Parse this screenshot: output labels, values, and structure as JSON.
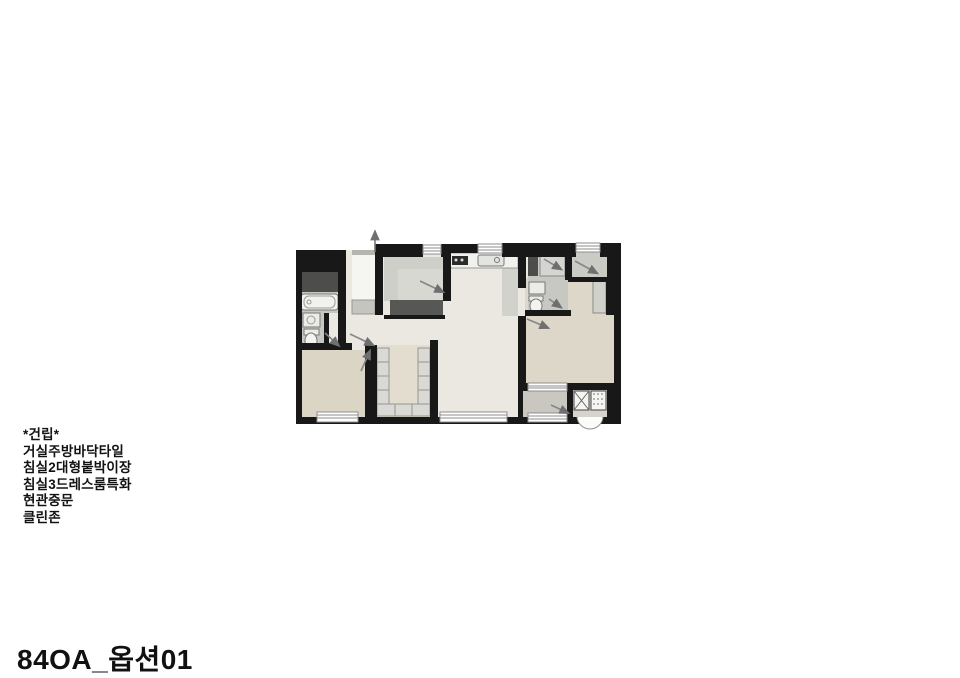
{
  "title": "84OA_옵션01",
  "notes": {
    "header": "*건립*",
    "items": [
      "거실주방바닥타일",
      "침실2대형붙박이장",
      "침실3드레스룸특화",
      "현관중문",
      "클린존"
    ]
  },
  "floor_plan": {
    "colors": {
      "wall": "#181818",
      "floor_light": "#ebe8e1",
      "bedroom_floor": "#dbd5c5",
      "master_floor": "#dcd7c9",
      "bath_floor": "#c8c8c3",
      "pantry_floor": "#cfcfc9",
      "balcony_floor": "#c9c7c0",
      "utility_dark": "#4d4d4b",
      "window": "#ffffff",
      "fixture_line": "#85858a"
    }
  }
}
